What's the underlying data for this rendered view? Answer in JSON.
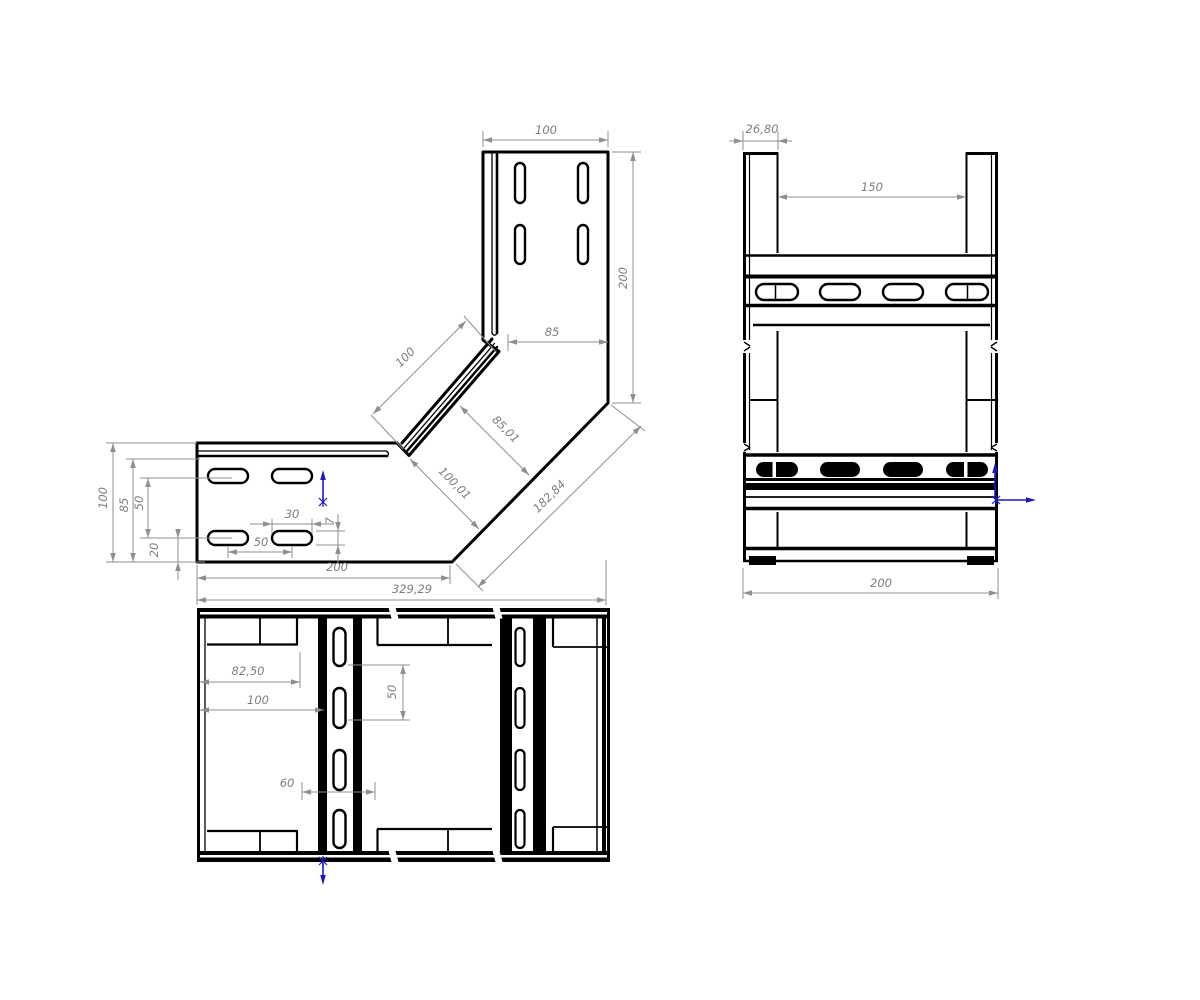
{
  "drawing": {
    "kind": "cable-tray-90-degree-elbow-technical-drawing",
    "colors": {
      "background": "#ffffff",
      "line": "#000000",
      "dim_line": "#8f8f8f",
      "dim_text": "#7d7d7d",
      "accent_arrow": "#1a1abe"
    }
  },
  "views": {
    "front": {
      "name": "front-elbow-view",
      "dimensions": [
        {
          "name": "top-width",
          "label": "100",
          "line": [
            483,
            140,
            608,
            140
          ],
          "ext": [
            [
              483,
              147,
              483,
              131
            ],
            [
              608,
              147,
              608,
              131
            ]
          ],
          "text": [
            546,
            134
          ],
          "rot": 0
        },
        {
          "name": "right-height",
          "label": "200",
          "line": [
            633,
            152,
            633,
            403
          ],
          "ext": [
            [
              612,
              152,
              641,
              152
            ],
            [
              612,
              403,
              641,
              403
            ]
          ],
          "text": [
            627,
            278
          ],
          "rot": -90
        },
        {
          "name": "upper-inner",
          "label": "85",
          "line": [
            508,
            342,
            608,
            342
          ],
          "ext": [
            [
              508,
              351,
              508,
              334
            ]
          ],
          "text": [
            552,
            336
          ],
          "rot": 0
        },
        {
          "name": "diagonal-flange",
          "label": "100",
          "line": [
            373,
            414,
            466,
            321
          ],
          "ext": [
            [
              403,
              449,
              371,
              415
            ],
            [
              496,
              352,
              464,
              316
            ]
          ],
          "text": [
            408,
            360
          ],
          "rot": -45
        },
        {
          "name": "diagonal-width-a",
          "label": "85,01",
          "line": [
            460,
            406,
            529,
            475
          ],
          "ext": [],
          "text": [
            503,
            432
          ],
          "rot": 45
        },
        {
          "name": "diagonal-width-b",
          "label": "100,01",
          "line": [
            410,
            459,
            479,
            529
          ],
          "ext": [],
          "text": [
            452,
            486
          ],
          "rot": 45
        },
        {
          "name": "diagonal-outer",
          "label": "182,84",
          "line": [
            478,
            587,
            641,
            426
          ],
          "ext": [
            [
              456,
              564,
              483,
              591
            ],
            [
              611,
              405,
              645,
              431
            ]
          ],
          "text": [
            552,
            499
          ],
          "rot": -45
        },
        {
          "name": "arm-length",
          "label": "200",
          "line": [
            197,
            578,
            450,
            578
          ],
          "ext": [
            [
              450,
              565,
              450,
              584
            ]
          ],
          "text": [
            337,
            571
          ],
          "rot": 0
        },
        {
          "name": "total-width",
          "label": "329,29",
          "line": [
            197,
            600,
            606,
            600
          ],
          "ext": [
            [
              197,
              565,
              197,
              605
            ],
            [
              606,
              560,
              606,
              605
            ]
          ],
          "text": [
            412,
            593
          ],
          "rot": 0
        },
        {
          "name": "left-height",
          "label": "100",
          "line": [
            113,
            443,
            113,
            562
          ],
          "ext": [
            [
              106,
              443,
              197,
              443
            ],
            [
              106,
              562,
              197,
              562
            ]
          ],
          "text": [
            107,
            498
          ],
          "rot": -90
        },
        {
          "name": "left-inner",
          "label": "85",
          "line": [
            133,
            459,
            133,
            562
          ],
          "ext": [
            [
              126,
              459,
              200,
              459
            ]
          ],
          "text": [
            128,
            505
          ],
          "rot": -90
        },
        {
          "name": "slot-row-spacing",
          "label": "50",
          "line": [
            148,
            478,
            148,
            538
          ],
          "ext": [
            [
              140,
              478,
              232,
              478
            ],
            [
              140,
              538,
              232,
              538
            ]
          ],
          "text": [
            143,
            503
          ],
          "rot": -90
        },
        {
          "name": "bottom-offset",
          "label": "20",
          "style": "out",
          "line": [
            178,
            530,
            178,
            580
          ],
          "tips": [
            [
              178,
              538
            ],
            [
              178,
              562
            ]
          ],
          "ext": [
            [
              166,
              562,
              205,
              562
            ]
          ],
          "text": [
            158,
            550
          ],
          "rot": -90
        },
        {
          "name": "slot-length",
          "label": "30",
          "style": "out",
          "line": [
            250,
            524,
            334,
            524
          ],
          "tips": [
            [
              272,
              524
            ],
            [
              312,
              524
            ]
          ],
          "ext": [
            [
              272,
              519,
              272,
              534
            ],
            [
              312,
              519,
              312,
              534
            ]
          ],
          "text": [
            292,
            518
          ],
          "rot": 0
        },
        {
          "name": "slot-height",
          "label": "7",
          "style": "out",
          "line": [
            338,
            514,
            338,
            564
          ],
          "tips": [
            [
              338,
              531
            ],
            [
              338,
              545
            ]
          ],
          "ext": [
            [
              316,
              531,
              345,
              531
            ],
            [
              316,
              545,
              345,
              545
            ]
          ],
          "text": [
            334,
            521
          ],
          "rot": -90
        },
        {
          "name": "slot-pitch",
          "label": "50",
          "line": [
            228,
            552,
            292,
            552
          ],
          "ext": [
            [
              228,
              546,
              228,
              558
            ],
            [
              292,
              546,
              292,
              558
            ]
          ],
          "text": [
            261,
            546
          ],
          "rot": 0
        }
      ]
    },
    "side": {
      "name": "side-channel-view",
      "dimensions": [
        {
          "name": "flange-width",
          "label": "26,80",
          "style": "out",
          "line": [
            729,
            141,
            792,
            141
          ],
          "tips": [
            [
              743,
              141
            ],
            [
              778,
              141
            ]
          ],
          "ext": [
            [
              743,
              150,
              743,
              131
            ],
            [
              778,
              150,
              778,
              131
            ]
          ],
          "text": [
            762,
            133
          ],
          "rot": 0
        },
        {
          "name": "inner-width",
          "label": "150",
          "line": [
            778,
            197,
            966,
            197
          ],
          "ext": [],
          "text": [
            872,
            191
          ],
          "rot": 0
        },
        {
          "name": "overall-width",
          "label": "200",
          "line": [
            743,
            593,
            998,
            593
          ],
          "ext": [
            [
              743,
              568,
              743,
              599
            ],
            [
              998,
              568,
              998,
              599
            ]
          ],
          "text": [
            881,
            587
          ],
          "rot": 0
        }
      ]
    },
    "plan": {
      "name": "plan-bottom-view",
      "dimensions": [
        {
          "name": "edge-to-wing",
          "label": "82,50",
          "line": [
            200,
            682,
            300,
            682
          ],
          "ext": [
            [
              300,
              652,
              300,
              688
            ]
          ],
          "text": [
            248,
            675
          ],
          "rot": 0
        },
        {
          "name": "edge-to-rung",
          "label": "100",
          "line": [
            200,
            710,
            324,
            710
          ],
          "ext": [],
          "text": [
            258,
            704
          ],
          "rot": 0
        },
        {
          "name": "rung-slot-spacing",
          "label": "50",
          "line": [
            403,
            665,
            403,
            720
          ],
          "ext": [
            [
              348,
              665,
              410,
              665
            ],
            [
              348,
              720,
              410,
              720
            ]
          ],
          "text": [
            396,
            692
          ],
          "rot": -90
        },
        {
          "name": "rung-clearance",
          "label": "60",
          "line": [
            302,
            792,
            375,
            792
          ],
          "ext": [
            [
              302,
              782,
              302,
              800
            ],
            [
              375,
              782,
              375,
              800
            ]
          ],
          "text": [
            287,
            787
          ],
          "rot": 0
        }
      ]
    }
  }
}
